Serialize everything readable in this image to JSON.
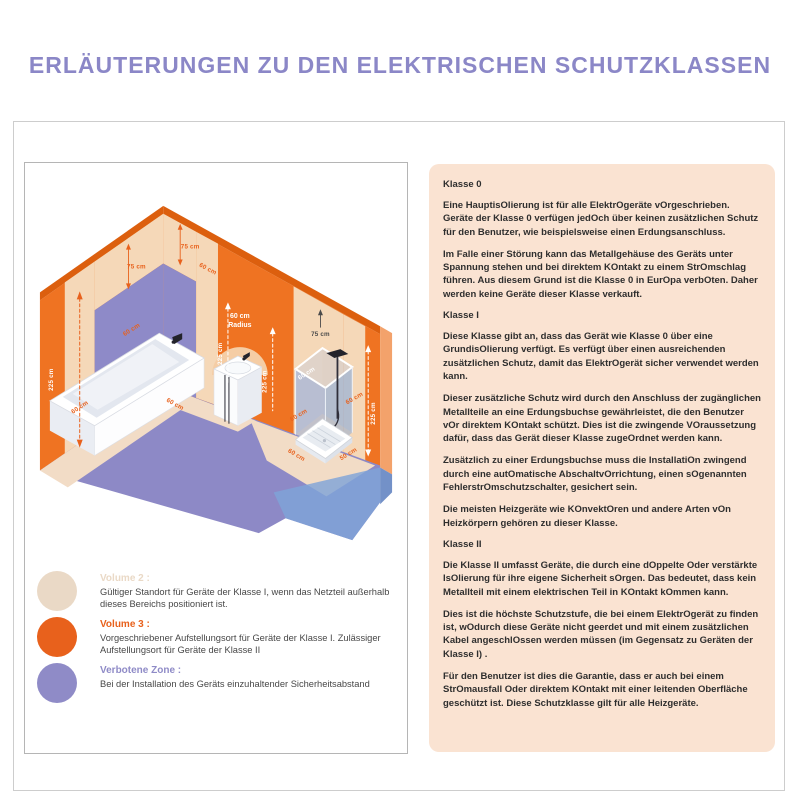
{
  "title": "ERLÄUTERUNGEN ZU DEN ELEKTRISCHEN SCHUTZKLASSEN",
  "colors": {
    "title": "#8b87c7",
    "wall_orange": "#ef7322",
    "accent_orange": "#e8611c",
    "zone_beige": "#f5d8b8",
    "zone_purple": "#8e8ac8",
    "glass_blue": "#8fa9dc",
    "panel_peach": "#fae3d2"
  },
  "diagram": {
    "labels": {
      "cm225": "225 cm",
      "cm75": "75 cm",
      "cm60": "60 cm",
      "cm50": "50 cm",
      "radius_l1": "60 cm",
      "radius_l2": "Radius"
    }
  },
  "legend": {
    "items": [
      {
        "label": "Volume 2 :",
        "color": "#ead9c6",
        "description": "Gültiger Standort für Geräte der Klasse I, wenn das Netzteil außerhalb dieses Bereichs positioniert ist."
      },
      {
        "label": "Volume 3 :",
        "color": "#e8611c",
        "description": "Vorgeschriebener Aufstellungsort für Geräte der Klasse I. Zulässiger Aufstellungsort für Geräte der Klasse II"
      },
      {
        "label": "Verbotene Zone :",
        "color": "#8f8bc7",
        "description": "Bei der Installation des Geräts einzuhaltender Sicherheitsabstand"
      }
    ]
  },
  "info_panel": {
    "sections": [
      {
        "style": "heading",
        "text": "Klasse 0"
      },
      {
        "style": "para",
        "text": "Eine HauptisOlierung ist für alle ElektrOgeräte vOrgeschrieben. Geräte der Klasse 0 verfügen jedOch über keinen zusätzlichen Schutz für den Benutzer, wie beispielsweise einen Erdungsanschluss."
      },
      {
        "style": "para",
        "text": "Im Falle einer Störung kann das Metallgehäuse des Geräts unter Spannung stehen und bei direktem KOntakt zu einem StrOmschlag führen. Aus diesem Grund ist die Klasse 0 in EurOpa verbOten. Daher werden keine Geräte dieser Klasse verkauft."
      },
      {
        "style": "heading",
        "text": "Klasse I"
      },
      {
        "style": "para",
        "text": "Diese Klasse gibt an, dass das Gerät wie Klasse 0 über eine GrundisOlierung verfügt. Es verfügt über einen ausreichenden zusätzlichen Schutz, damit das ElektrOgerät sicher verwendet werden kann."
      },
      {
        "style": "para",
        "text": "Dieser zusätzliche Schutz wird durch den Anschluss der zugänglichen Metallteile an eine Erdungsbuchse gewährleistet, die den Benutzer vOr direktem KOntakt schützt. Dies ist die zwingende VOraussetzung dafür, dass das Gerät dieser Klasse zugeOrdnet werden kann."
      },
      {
        "style": "para",
        "text": "Zusätzlich zu einer Erdungsbuchse muss die InstallatiOn zwingend durch eine autOmatische AbschaltvOrrichtung, einen sOgenannten FehlerstrOmschutzschalter, gesichert sein."
      },
      {
        "style": "para",
        "text": "Die meisten Heizgeräte wie KOnvektOren und andere Arten vOn Heizkörpern gehören zu dieser Klasse."
      },
      {
        "style": "heading",
        "text": "Klasse II"
      },
      {
        "style": "para",
        "text": "Die Klasse II umfasst Geräte, die durch eine dOppelte Oder verstärkte IsOlierung für ihre eigene Sicherheit sOrgen. Das bedeutet, dass kein Metallteil mit einem elektrischen Teil in KOntakt kOmmen kann."
      },
      {
        "style": "para",
        "text": "Dies ist die höchste Schutzstufe, die bei einem ElektrOgerät zu finden ist, wOdurch diese Geräte nicht geerdet und mit einem zusätzlichen Kabel angeschlOssen werden müssen (im Gegensatz zu Geräten der Klasse I) ."
      },
      {
        "style": "para",
        "text": "Für den Benutzer ist dies die Garantie, dass er auch bei einem StrOmausfall Oder direktem KOntakt mit einer leitenden Oberfläche geschützt ist. Diese Schutzklasse gilt für alle Heizgeräte."
      }
    ]
  }
}
